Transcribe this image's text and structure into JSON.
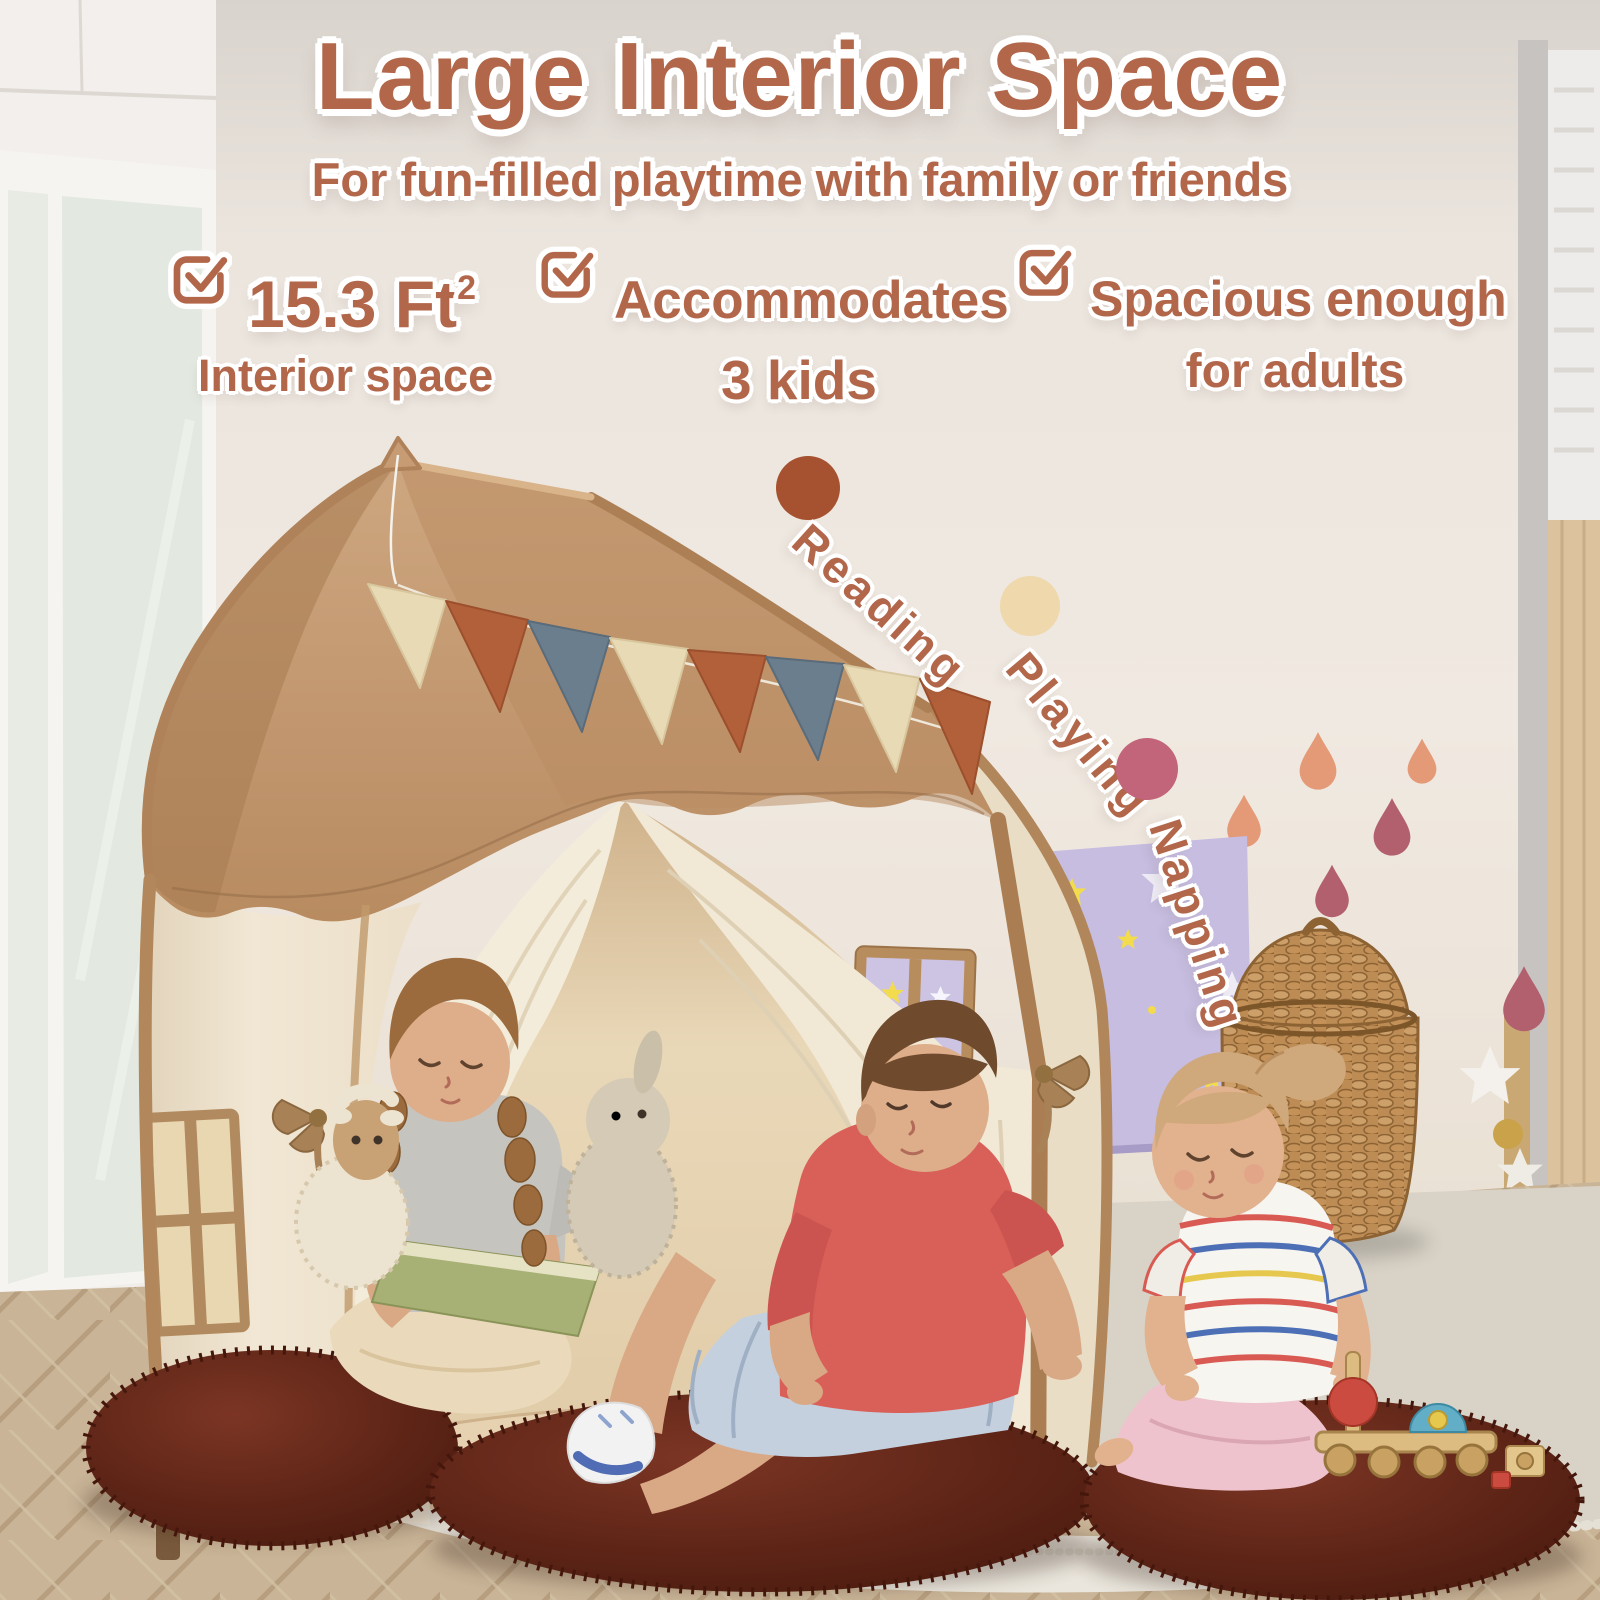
{
  "header": {
    "title": "Large Interior Space",
    "subtitle": "For fun-filled playtime with family or friends"
  },
  "features": [
    {
      "icon": "checkbox-icon",
      "value": "15.3 Ft",
      "sup": "2",
      "label": "Interior space"
    },
    {
      "icon": "checkbox-icon",
      "value": "Accommodates",
      "label": "3 kids"
    },
    {
      "icon": "checkbox-icon",
      "value": "Spacious enough",
      "label": "for adults"
    }
  ],
  "activities": [
    {
      "label": "Reading",
      "dot_color": "#a6512f"
    },
    {
      "label": "Playing",
      "dot_color": "#eed8ac"
    },
    {
      "label": "Napping",
      "dot_color": "#c2647a"
    }
  ],
  "palette": {
    "text_brown": "#b2674a",
    "wall_background": "#ece6df",
    "tent_roof_tan": "#c49a74",
    "tent_valance": "#b68a5d",
    "tent_wall_cream": "#f2e9d8",
    "tent_trim": "#b1865a",
    "bunting_cream": "#e9dab6",
    "bunting_rust": "#b2603a",
    "bunting_blue": "#6b7e8e",
    "cushion_maroon": "#5c2418",
    "poster_purple": "#c6bde0",
    "poster_star_yellow": "#f2dc4e",
    "basket_wicker": "#bd8c54",
    "drop_salmon": "#e59a77",
    "drop_mauve": "#b2606e"
  }
}
